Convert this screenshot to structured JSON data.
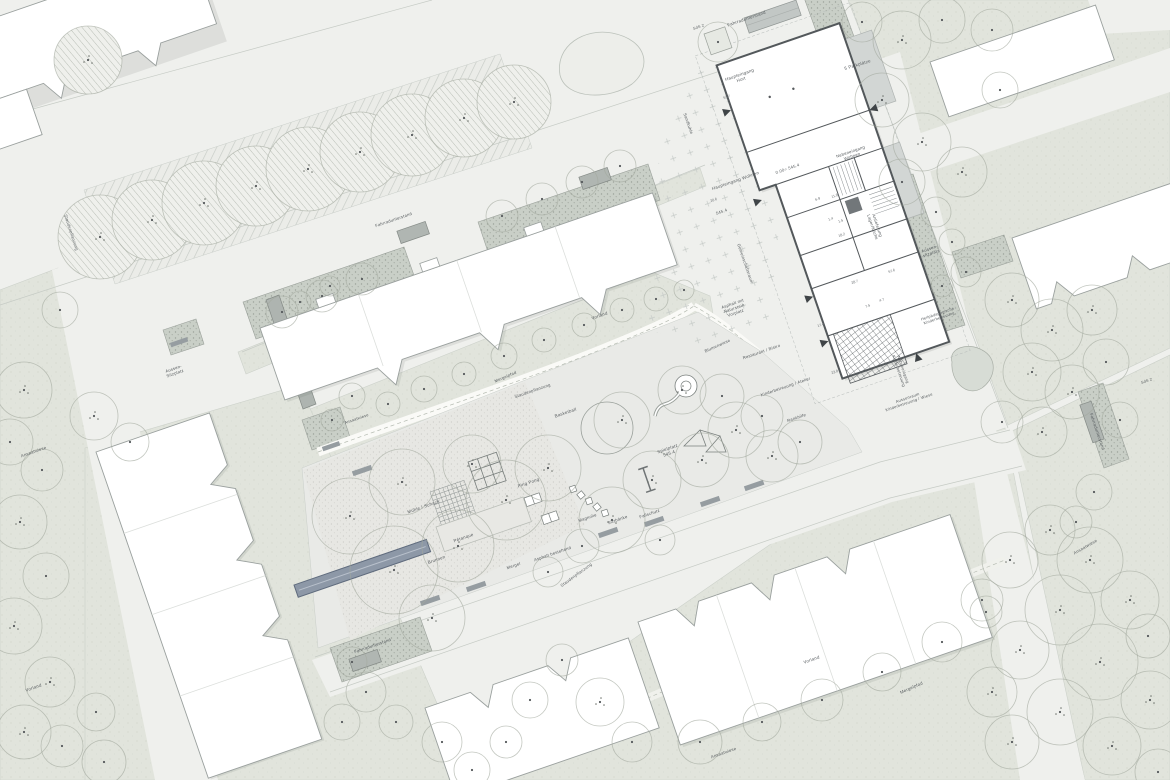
{
  "colors": {
    "street": "#eff0ed",
    "green": "#e1e4dc",
    "planting_strip": "#c9cfc7",
    "building_fill": "#ffffff",
    "wall": "#53585b",
    "fountain": "#8d98a7",
    "label_text": "#565b5e"
  },
  "labels": [
    {
      "name": "label-fahrradunterstand-top",
      "text": "Fahrradunterstand",
      "x": 747,
      "y": 20,
      "rot": -19,
      "size": 4.4
    },
    {
      "name": "label-haupteingang-hort",
      "lines": [
        "Haupteingang",
        "Hort"
      ],
      "x": 740,
      "y": 76,
      "rot": -19,
      "size": 4.4
    },
    {
      "name": "label-parkplaetze",
      "text": "5 Parkplätze",
      "x": 858,
      "y": 66,
      "rot": -17,
      "size": 4.4
    },
    {
      "name": "label-sds2-top",
      "text": "SdS 2",
      "x": 699,
      "y": 28,
      "rot": -19,
      "size": 3.8
    },
    {
      "name": "label-nebeneingang-wohnen",
      "lines": [
        "Nebeneingang",
        "Wohnen"
      ],
      "x": 851,
      "y": 153,
      "rot": -19,
      "size": 4.2
    },
    {
      "name": "label-haupteingang-wohnen",
      "text": "Haupteingang Wohnen",
      "x": 736,
      "y": 182,
      "rot": -19,
      "size": 4.4
    },
    {
      "name": "label-hoehe-null",
      "text": "0.00= 545.4",
      "x": 788,
      "y": 170,
      "rot": -19,
      "size": 4.2
    },
    {
      "name": "label-hoehe-545",
      "text": "545.4",
      "x": 722,
      "y": 213,
      "rot": -19,
      "size": 4.2
    },
    {
      "name": "label-gemeinschaftsraum",
      "text": "Gemeinschaftsraum",
      "x": 744,
      "y": 264,
      "rot": 71,
      "size": 4.2
    },
    {
      "name": "label-anlieferung",
      "lines": [
        "Anlieferung",
        "Lager/Küche"
      ],
      "x": 876,
      "y": 226,
      "rot": 71,
      "size": 4.2
    },
    {
      "name": "label-sandkuhle",
      "text": "Sandkuhle",
      "x": 687,
      "y": 124,
      "rot": 71,
      "size": 4.2
    },
    {
      "name": "label-asphalt-naturstein",
      "lines": [
        "Asphalt mit",
        "Naturstein",
        "Vorplatz"
      ],
      "x": 733,
      "y": 305,
      "rot": -19,
      "size": 4.2
    },
    {
      "name": "label-blumenwiese",
      "text": "Blumenwiese",
      "x": 718,
      "y": 347,
      "rot": -24,
      "size": 4.2
    },
    {
      "name": "label-restaurant-bistro",
      "text": "Restaurant / Bistro",
      "x": 762,
      "y": 353,
      "rot": -19,
      "size": 4.2
    },
    {
      "name": "label-kinderbetreuung-atelier",
      "text": "Kinderbetreuung / Atelier",
      "x": 786,
      "y": 388,
      "rot": -19,
      "size": 4.2
    },
    {
      "name": "label-rankhilfe",
      "text": "Rankhilfe",
      "x": 797,
      "y": 419,
      "rot": -19,
      "size": 4.2
    },
    {
      "name": "label-heilpaedagogische",
      "lines": [
        "Heilpädagogische",
        "Kinderbetreuung"
      ],
      "x": 938,
      "y": 315,
      "rot": -19,
      "size": 3.9
    },
    {
      "name": "label-nebeneingang-kinderbetreuung",
      "lines": [
        "Nebeneingang",
        "Kinderbetreuung"
      ],
      "x": 902,
      "y": 370,
      "rot": 71,
      "size": 4.0
    },
    {
      "name": "label-aussenraum-kinderbetreuung",
      "lines": [
        "Aussenraum",
        "Kinderbetreuung / Wiese"
      ],
      "x": 908,
      "y": 399,
      "rot": -19,
      "size": 4.0
    },
    {
      "name": "label-aussensitzplatz-rechts",
      "lines": [
        "Aussen-",
        "sitzplatz"
      ],
      "x": 930,
      "y": 250,
      "rot": -19,
      "size": 4.2
    },
    {
      "name": "label-aussensitzplatz-links",
      "lines": [
        "Aussen-",
        "Sitzplatz"
      ],
      "x": 174,
      "y": 370,
      "rot": -19,
      "size": 4.2
    },
    {
      "name": "label-muehle-schach",
      "text": "Mühle / Schach",
      "x": 424,
      "y": 508,
      "rot": -19,
      "size": 4.4
    },
    {
      "name": "label-petanque",
      "text": "Pétanque",
      "x": 464,
      "y": 539,
      "rot": -19,
      "size": 4.4
    },
    {
      "name": "label-brunnen",
      "text": "Brunnen",
      "x": 437,
      "y": 561,
      "rot": -19,
      "size": 4.4
    },
    {
      "name": "label-ping-pong",
      "text": "Ping Pong",
      "x": 529,
      "y": 484,
      "rot": -19,
      "size": 4.4
    },
    {
      "name": "label-basketball",
      "text": "Basketball",
      "x": 566,
      "y": 414,
      "rot": -19,
      "size": 4.4
    },
    {
      "name": "label-spielplatz",
      "lines": [
        "Spielplatz",
        "545.4"
      ],
      "x": 668,
      "y": 450,
      "rot": -19,
      "size": 4.4
    },
    {
      "name": "label-magnolie",
      "text": "Magnolie",
      "x": 588,
      "y": 519,
      "rot": -19,
      "size": 4.2
    },
    {
      "name": "label-sitzbaenke",
      "text": "Sitzbänke",
      "x": 618,
      "y": 521,
      "rot": -19,
      "size": 4.2
    },
    {
      "name": "label-fallschutz",
      "text": "Fallschutz",
      "x": 650,
      "y": 515,
      "rot": -19,
      "size": 4.2
    },
    {
      "name": "label-mergel",
      "text": "Mergel",
      "x": 514,
      "y": 567,
      "rot": -19,
      "size": 4.2
    },
    {
      "name": "label-asphalt-bestehend",
      "text": "Asphalt bestehend",
      "x": 553,
      "y": 555,
      "rot": -19,
      "size": 4.2
    },
    {
      "name": "label-staudenpflanzung-1",
      "text": "Staudenpflanzung",
      "x": 577,
      "y": 576,
      "rot": -36,
      "size": 4.2
    },
    {
      "name": "label-staudenpflanzung-2",
      "text": "Staudenpflanzung",
      "x": 533,
      "y": 392,
      "rot": -19,
      "size": 4.2
    },
    {
      "name": "label-staudenpflanzung-3",
      "text": "Staudenpflanzung",
      "x": 70,
      "y": 233,
      "rot": 72,
      "size": 4.2
    },
    {
      "name": "label-mergelpfad-1",
      "text": "Mergelpfad",
      "x": 506,
      "y": 378,
      "rot": -23,
      "size": 4.2
    },
    {
      "name": "label-fahrradunterstand-2",
      "text": "Fahrradunterstand",
      "x": 394,
      "y": 221,
      "rot": -19,
      "size": 4.2
    },
    {
      "name": "label-fahrradunterstand-3",
      "text": "Fahrradunterstand",
      "x": 373,
      "y": 647,
      "rot": -19,
      "size": 4.2
    },
    {
      "name": "label-fahrradunterstand-4",
      "text": "Fahrradunterstand",
      "x": 1096,
      "y": 432,
      "rot": 71,
      "size": 4.2
    },
    {
      "name": "label-ansaatwiese-1",
      "text": "Ansaatwiese",
      "x": 34,
      "y": 453,
      "rot": -19,
      "size": 4.2
    },
    {
      "name": "label-ansaatwiese-2",
      "text": "Ansaatwiese",
      "x": 1086,
      "y": 548,
      "rot": -30,
      "size": 4.2
    },
    {
      "name": "label-ansaatwiese-3",
      "text": "Ansaatwiese",
      "x": 724,
      "y": 754,
      "rot": -19,
      "size": 4.2
    },
    {
      "name": "label-ansaatwiese-4",
      "text": "Ansaatwiese",
      "x": 357,
      "y": 420,
      "rot": -19,
      "size": 4.0
    },
    {
      "name": "label-vorland-1",
      "text": "Vorland",
      "x": 600,
      "y": 317,
      "rot": -19,
      "size": 4.4
    },
    {
      "name": "label-vorland-2",
      "text": "Vorland",
      "x": 812,
      "y": 661,
      "rot": -19,
      "size": 4.4
    },
    {
      "name": "label-vorland-3",
      "text": "Vorland",
      "x": 34,
      "y": 689,
      "rot": -19,
      "size": 4.4
    },
    {
      "name": "label-mergelpfad-2",
      "text": "Mergelpfad",
      "x": 912,
      "y": 689,
      "rot": -24,
      "size": 4.4
    },
    {
      "name": "label-sds2-right",
      "text": "SdS 2",
      "x": 1147,
      "y": 382,
      "rot": -19,
      "size": 3.8
    }
  ],
  "rooms": [
    {
      "text": "53.7",
      "x": 727,
      "y": 98
    },
    {
      "text": "20.6",
      "x": 714,
      "y": 201
    },
    {
      "text": "6.9",
      "x": 818,
      "y": 200
    },
    {
      "text": "11.8",
      "x": 835,
      "y": 197
    },
    {
      "text": "1.4",
      "x": 831,
      "y": 220
    },
    {
      "text": "1.5",
      "x": 841,
      "y": 222
    },
    {
      "text": "18.2",
      "x": 842,
      "y": 236
    },
    {
      "text": "57.6",
      "x": 892,
      "y": 272
    },
    {
      "text": "28.7",
      "x": 855,
      "y": 283
    },
    {
      "text": "7.5",
      "x": 868,
      "y": 307
    },
    {
      "text": "4.7",
      "x": 882,
      "y": 301
    },
    {
      "text": "17.4",
      "x": 821,
      "y": 326
    },
    {
      "text": "23.8",
      "x": 835,
      "y": 373
    }
  ]
}
